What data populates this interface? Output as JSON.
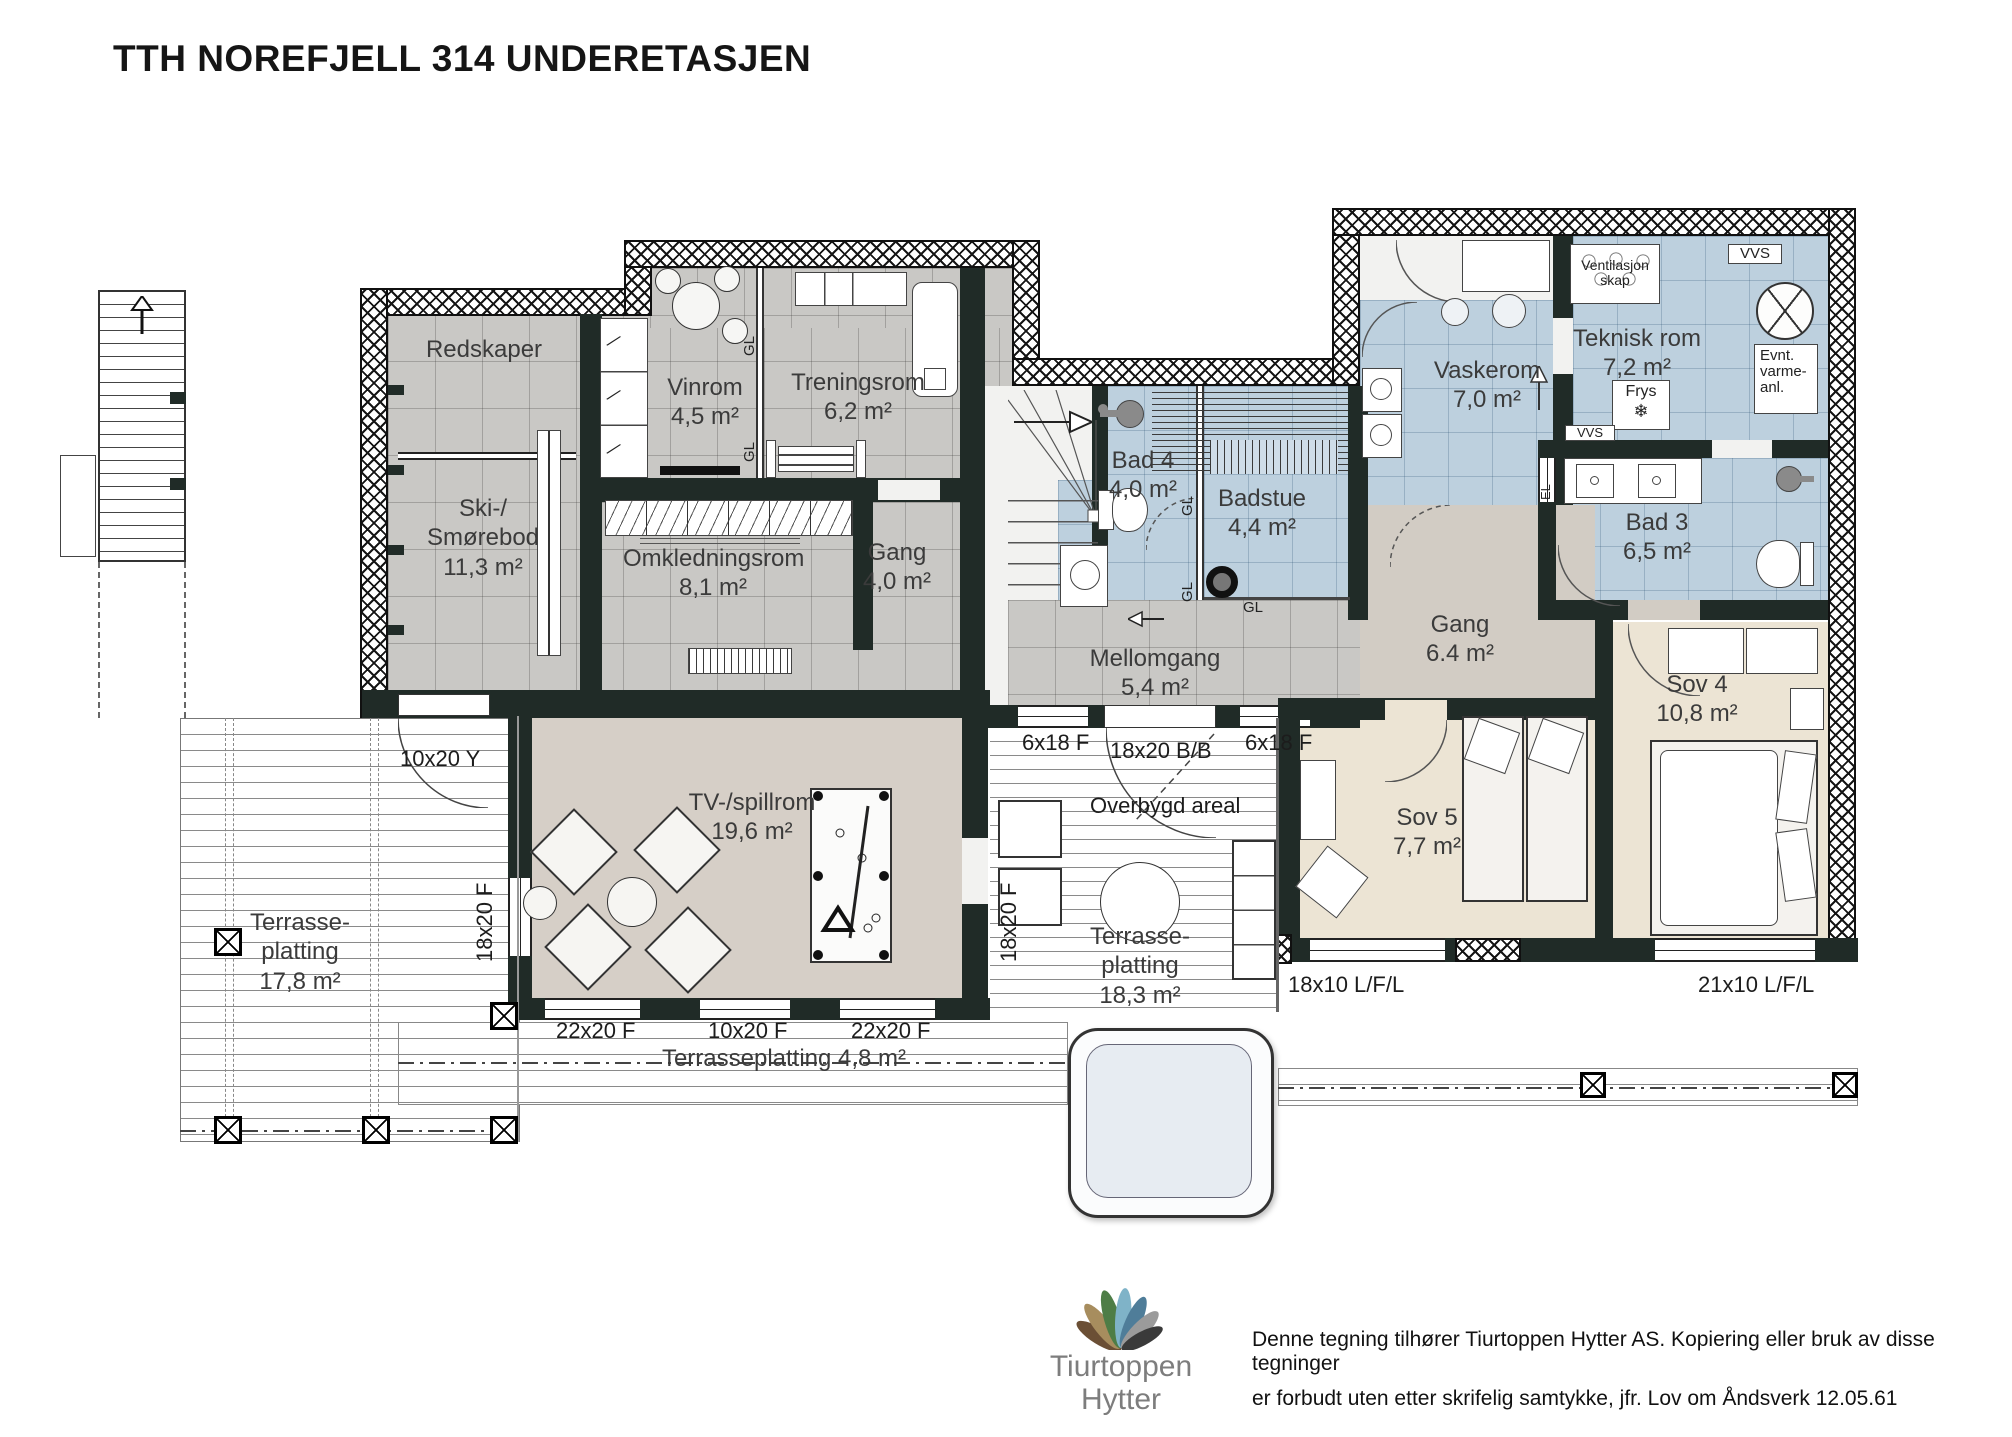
{
  "title": "TTH NOREFJELL 314 UNDERETASJEN",
  "rooms": {
    "redskaper": {
      "name": "Redskaper"
    },
    "ski": {
      "name": "Ski-/\nSmørebod",
      "area": "11,3 m²"
    },
    "vinrom": {
      "name": "Vinrom",
      "area": "4,5 m²"
    },
    "treningsrom": {
      "name": "Treningsrom",
      "area": "6,2 m²"
    },
    "omkledningsrom": {
      "name": "Omkledningsrom",
      "area": "8,1 m²"
    },
    "gang_v": {
      "name": "Gang",
      "area": "4,0 m²"
    },
    "bad4": {
      "name": "Bad 4",
      "area": "4,0 m²"
    },
    "badstue": {
      "name": "Badstue",
      "area": "4,4 m²"
    },
    "mellomgang": {
      "name": "Mellomgang",
      "area": "5,4 m²"
    },
    "vaskerom": {
      "name": "Vaskerom",
      "area": "7,0 m²"
    },
    "teknisk": {
      "name": "Teknisk rom",
      "area": "7,2 m²"
    },
    "bad3": {
      "name": "Bad 3",
      "area": "6,5 m²"
    },
    "gang_h": {
      "name": "Gang",
      "area": "6.4 m²"
    },
    "sov4": {
      "name": "Sov 4",
      "area": "10,8 m²"
    },
    "sov5": {
      "name": "Sov 5",
      "area": "7,7 m²"
    },
    "tv": {
      "name": "TV-/spillrom",
      "area": "19,6 m²"
    }
  },
  "terraces": {
    "left": {
      "name": "Terrasse-\nplatting",
      "area": "17,8 m²"
    },
    "mid": {
      "name": "Terrasse-\nplatting",
      "area": "18,3 m²"
    },
    "strip": "Terrasseplatting 4,8 m²",
    "overbygd": "Overbygd areal"
  },
  "dims": {
    "door_y": "10x20 Y",
    "w1820f": "18x20 F",
    "w22": "22x20 F",
    "w10": "10x20 F",
    "w618": "6x18 F",
    "door_bb": "18x20 B/B",
    "w1810": "18x10 L/F/L",
    "w2110": "21x10 L/F/L"
  },
  "tags": {
    "gl": "GL",
    "el": "EL",
    "vvs": "VVS",
    "frys": "Frys",
    "snow": "❄",
    "vent": "Ventilasjon\nskap",
    "varme": "Evnt.\nvarme-\nanl."
  },
  "footer": {
    "brand_line1": "Tiurtoppen",
    "brand_line2": "Hytter",
    "legal_line1": "Denne tegning tilhører Tiurtoppen Hytter AS. Kopiering eller bruk av disse tegninger",
    "legal_line2": "er forbudt uten etter skrifelig samtykke, jfr. Lov om Åndsverk 12.05.61"
  },
  "colors": {
    "wall": "#202b27",
    "floor_gray": "#c9c8c5",
    "floor_blue": "#bdd0de",
    "floor_beige": "#ece4d4",
    "petals": [
      "#6b4f35",
      "#a78d5e",
      "#4e7d46",
      "#7fb3c8",
      "#4f7d99",
      "#9b9b9b",
      "#3a3a3a"
    ]
  }
}
